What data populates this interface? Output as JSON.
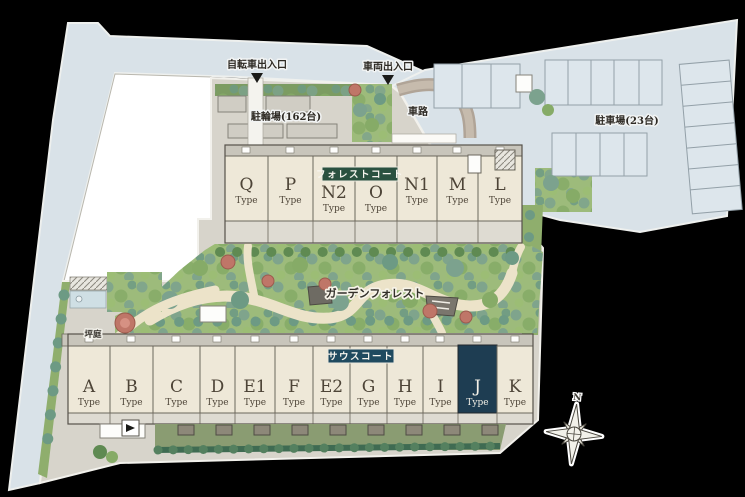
{
  "labels": {
    "bicycle_entrance": "自転車出入口",
    "vehicle_entrance": "車両出入口",
    "driveway": "車路",
    "bicycle_parking": "駐輪場(162台)",
    "car_parking": "駐車場(23台)",
    "garden_forest": "ガーデンフォレスト",
    "tsubo_garden": "坪庭",
    "compass_north": "N"
  },
  "forest_court": {
    "badge": "フォレストコート",
    "badge_color": "#2a5140",
    "units": [
      {
        "label": "Q",
        "sub": "Type"
      },
      {
        "label": "P",
        "sub": "Type"
      },
      {
        "label": "N2",
        "sub": "Type"
      },
      {
        "label": "O",
        "sub": "Type"
      },
      {
        "label": "N1",
        "sub": "Type"
      },
      {
        "label": "M",
        "sub": "Type"
      },
      {
        "label": "L",
        "sub": "Type"
      }
    ]
  },
  "south_court": {
    "badge": "サウスコート",
    "badge_color": "#1f4a5f",
    "highlighted_unit": "J",
    "highlight_color": "#1e3d52",
    "units": [
      {
        "label": "A",
        "sub": "Type"
      },
      {
        "label": "B",
        "sub": "Type"
      },
      {
        "label": "C",
        "sub": "Type"
      },
      {
        "label": "D",
        "sub": "Type"
      },
      {
        "label": "E1",
        "sub": "Type"
      },
      {
        "label": "F",
        "sub": "Type"
      },
      {
        "label": "E2",
        "sub": "Type"
      },
      {
        "label": "G",
        "sub": "Type"
      },
      {
        "label": "H",
        "sub": "Type"
      },
      {
        "label": "I",
        "sub": "Type"
      },
      {
        "label": "J",
        "sub": "Type",
        "highlighted": true
      },
      {
        "label": "K",
        "sub": "Type"
      }
    ]
  },
  "colors": {
    "background": "#000000",
    "road": "#d9e2e8",
    "site_ground": "#d7d4cb",
    "neighbor_building": "#ffffff",
    "building_fill": "#eee8d8",
    "garden_green": "#9dbb7b",
    "south_strip_green": "#8a9c72",
    "hedge_dark_green": "#3f6b52",
    "tree_teal": "#7ca28e",
    "tree_green": "#86ab67",
    "tree_red": "#bf7668",
    "path_cream": "#ece3c9"
  }
}
